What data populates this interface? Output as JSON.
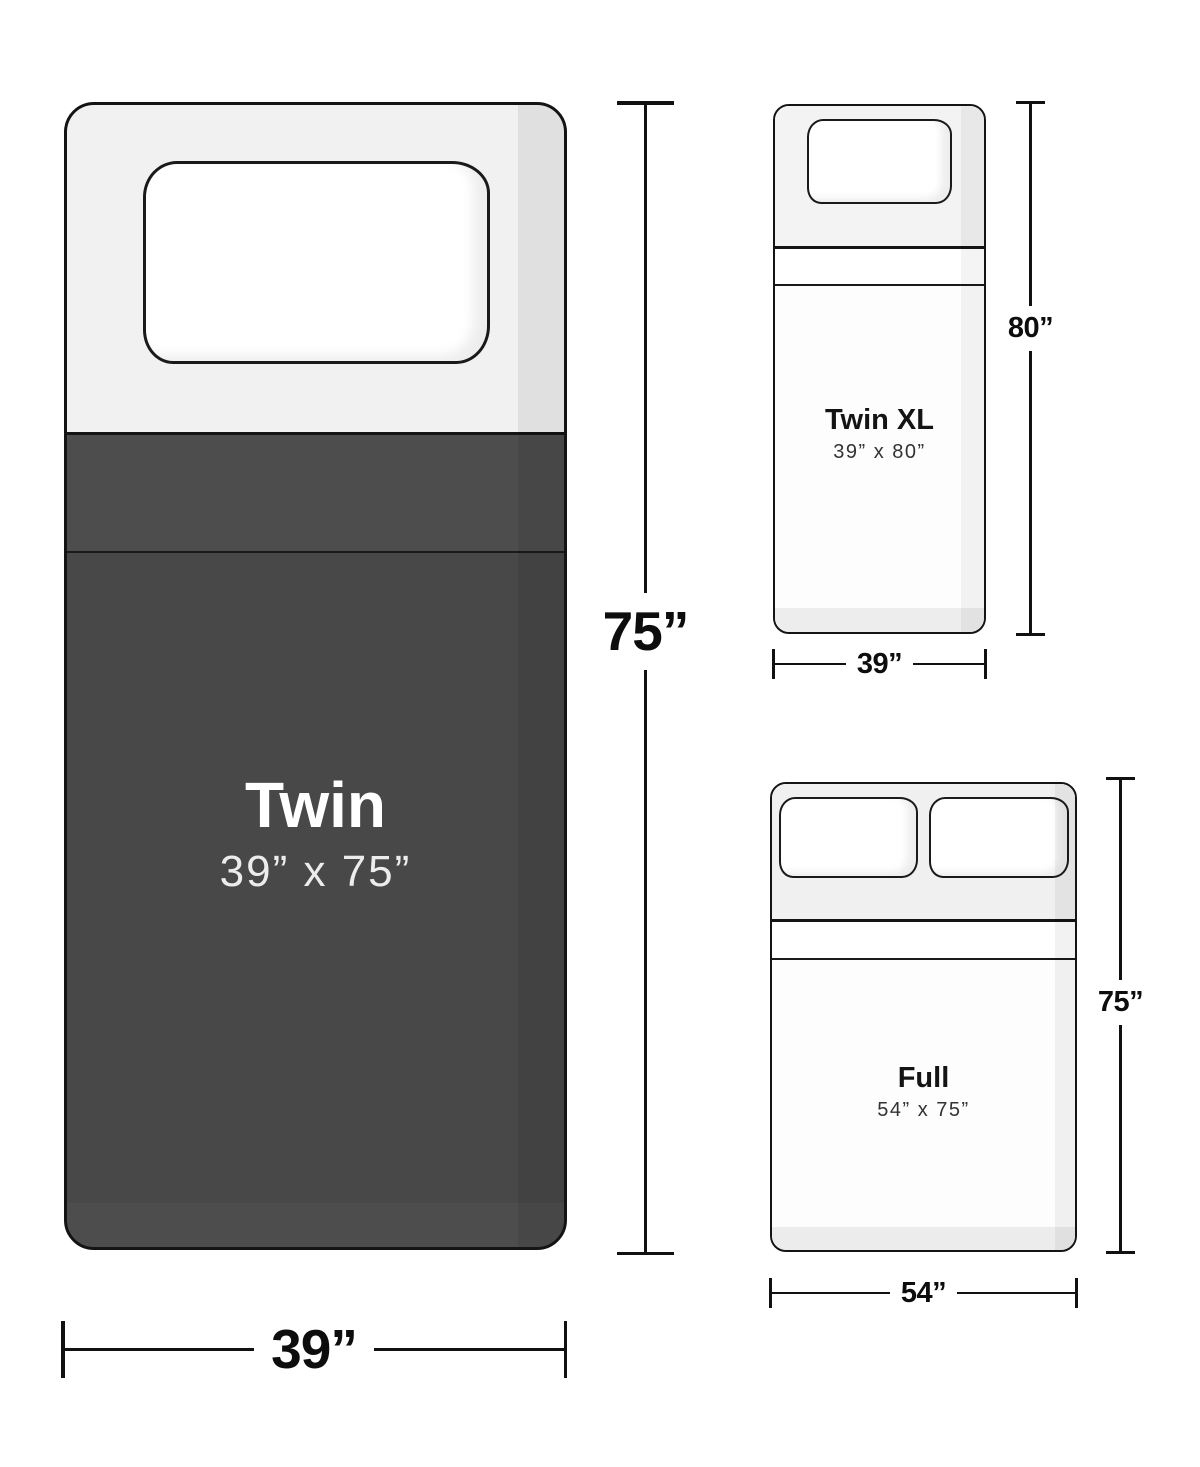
{
  "diagram": {
    "title": "Mattress size comparison",
    "beds": [
      {
        "id": "twin",
        "name": "Twin",
        "dimensions": "39” x 75”",
        "width_label": "39”",
        "height_label": "75”"
      },
      {
        "id": "twin-xl",
        "name": "Twin XL",
        "dimensions": "39” x 80”",
        "width_label": "39”",
        "height_label": "80”"
      },
      {
        "id": "full",
        "name": "Full",
        "dimensions": "54” x 75”",
        "width_label": "54”",
        "height_label": "75”"
      }
    ],
    "colors": {
      "blanket_dark": "#484848",
      "blanket_fold": "#4d4d4d",
      "linen_light": "#f1f1f1",
      "outline": "#141414",
      "background": "#ffffff"
    }
  }
}
